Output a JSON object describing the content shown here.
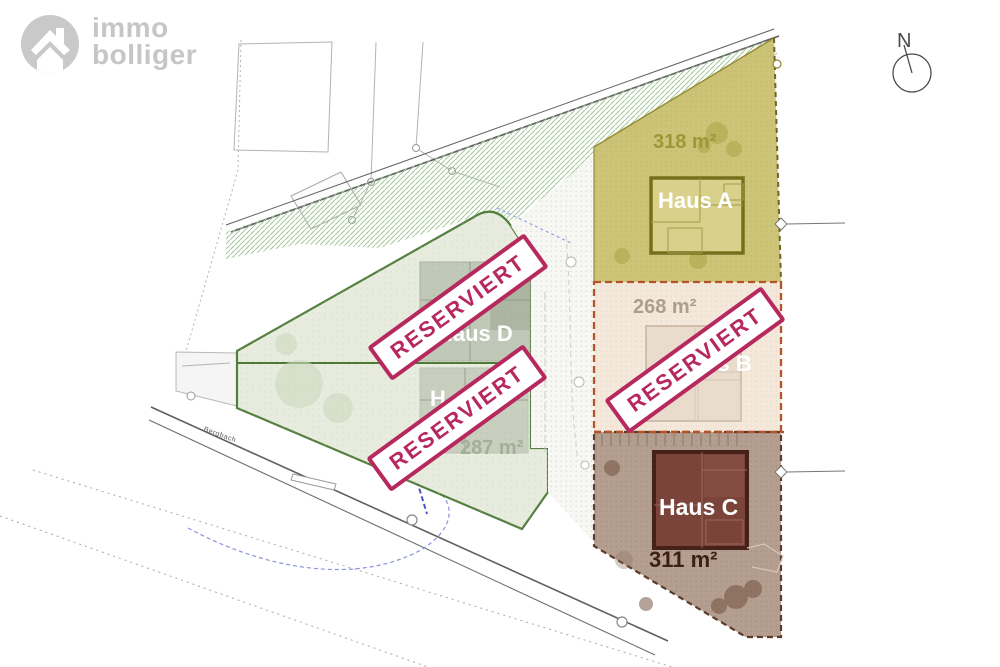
{
  "brand": {
    "line1": "immo",
    "line2": "bolliger"
  },
  "compass": {
    "label": "N"
  },
  "stream_label": "Bergbach",
  "plots": {
    "a": {
      "label": "Haus A",
      "area": "318 m²"
    },
    "b": {
      "label": "Haus B",
      "area": "268 m²",
      "status": "RESERVIERT"
    },
    "c": {
      "label": "Haus C",
      "area": "311 m²"
    },
    "d": {
      "label": "Haus D",
      "status": "RESERVIERT"
    },
    "e": {
      "label": "H",
      "area": "287 m²",
      "status": "RESERVIERT"
    }
  },
  "colors": {
    "stamp": "#b7285f",
    "plot_a_fill": "#c9c06e",
    "plot_b_fill": "#f2e7d9",
    "plot_c_fill": "#b19a8b",
    "plot_d_fill": "#e6ecdd",
    "divider_orange": "#b5542b",
    "boundary_green": "#4d7a37"
  }
}
